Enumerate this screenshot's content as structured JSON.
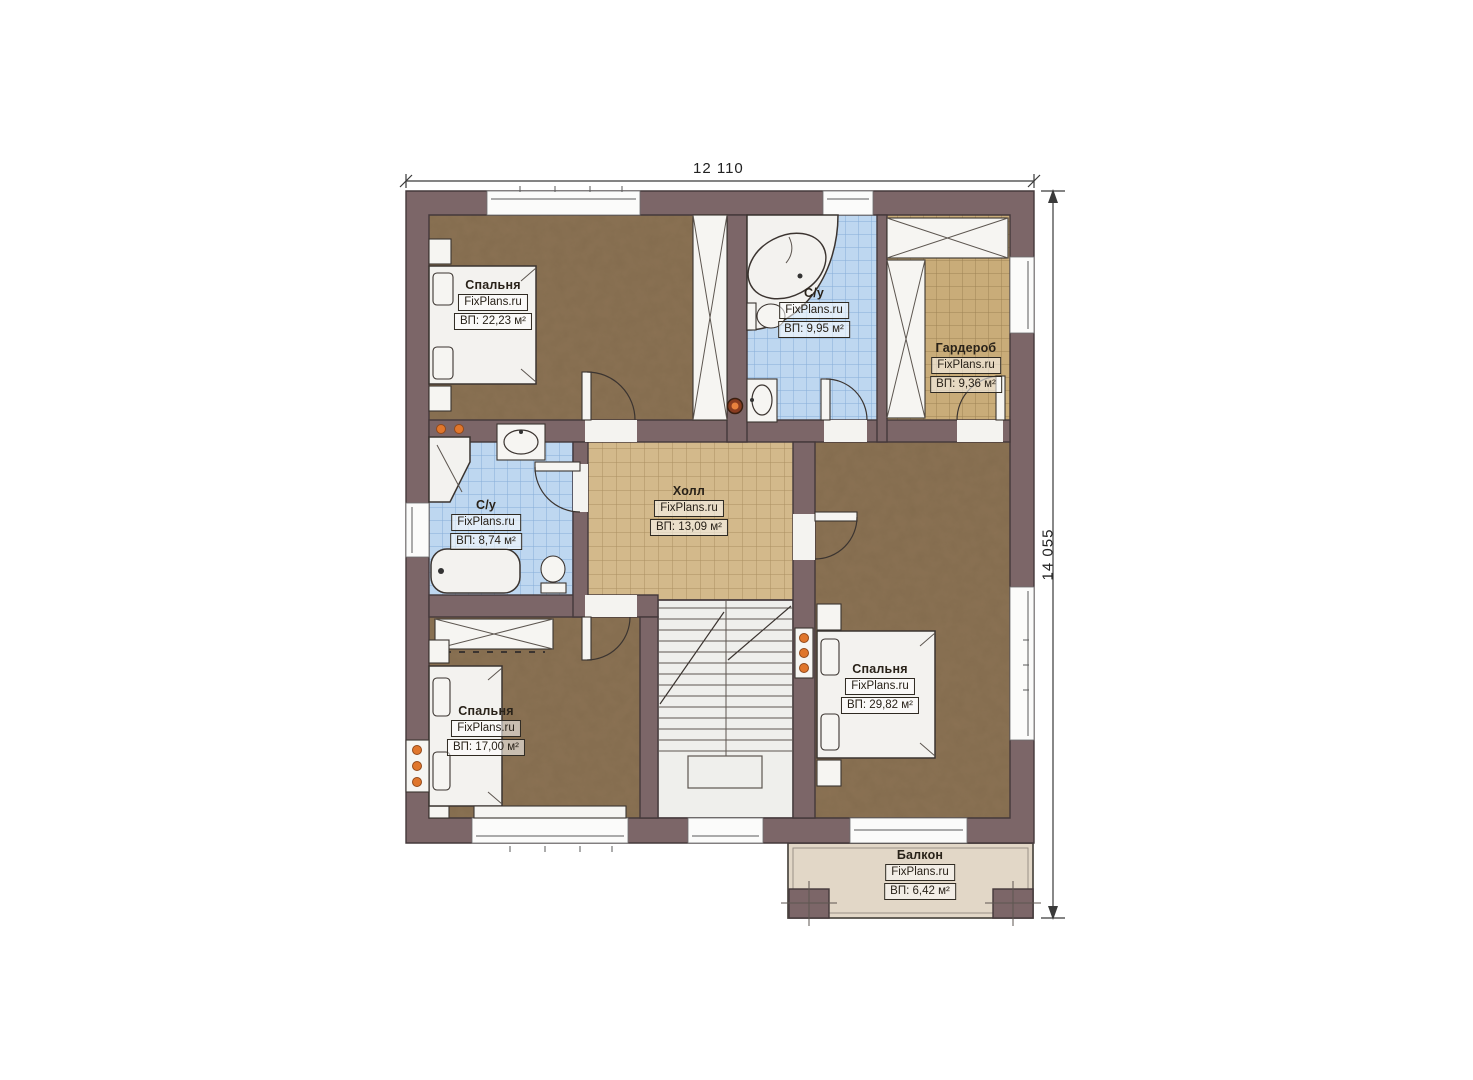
{
  "page_title": "Floor plan — second storey",
  "watermark": "FixPlans.ru",
  "dimensions": {
    "width_label": "12 110",
    "height_label": "14 055"
  },
  "rooms": [
    {
      "id": "bedroom-1",
      "name": "Спальня",
      "area": "ВП: 22,23 м²"
    },
    {
      "id": "bathroom-1",
      "name": "С/у",
      "area": "ВП: 9,95 м²"
    },
    {
      "id": "wardrobe",
      "name": "Гардероб",
      "area": "ВП: 9,36 м²"
    },
    {
      "id": "bathroom-2",
      "name": "С/у",
      "area": "ВП: 8,74 м²"
    },
    {
      "id": "hall",
      "name": "Холл",
      "area": "ВП: 13,09 м²"
    },
    {
      "id": "bedroom-2",
      "name": "Спальня",
      "area": "ВП: 29,82 м²"
    },
    {
      "id": "bedroom-3",
      "name": "Спальня",
      "area": "ВП: 17,00 м²"
    },
    {
      "id": "balcony",
      "name": "Балкон",
      "area": "ВП: 6,42 м²"
    }
  ],
  "fixtures": [
    "double-bed",
    "nightstand",
    "built-in-wardrobe",
    "corner-bathtub",
    "bathtub",
    "shower-cabin",
    "toilet",
    "washbasin",
    "staircase",
    "radiator",
    "balcony-post"
  ],
  "colors": {
    "wall": "#7c6668",
    "bedroom_floor": "#8b7254",
    "bathroom_tile": "#bed7f0",
    "hall_tile": "#d3b98b",
    "wardrobe_tile": "#c9ac79",
    "balcony_floor": "#e2d7c7",
    "stair_floor": "#efefec",
    "radiator_dot": "#e0762c",
    "outline": "#3b3430"
  }
}
